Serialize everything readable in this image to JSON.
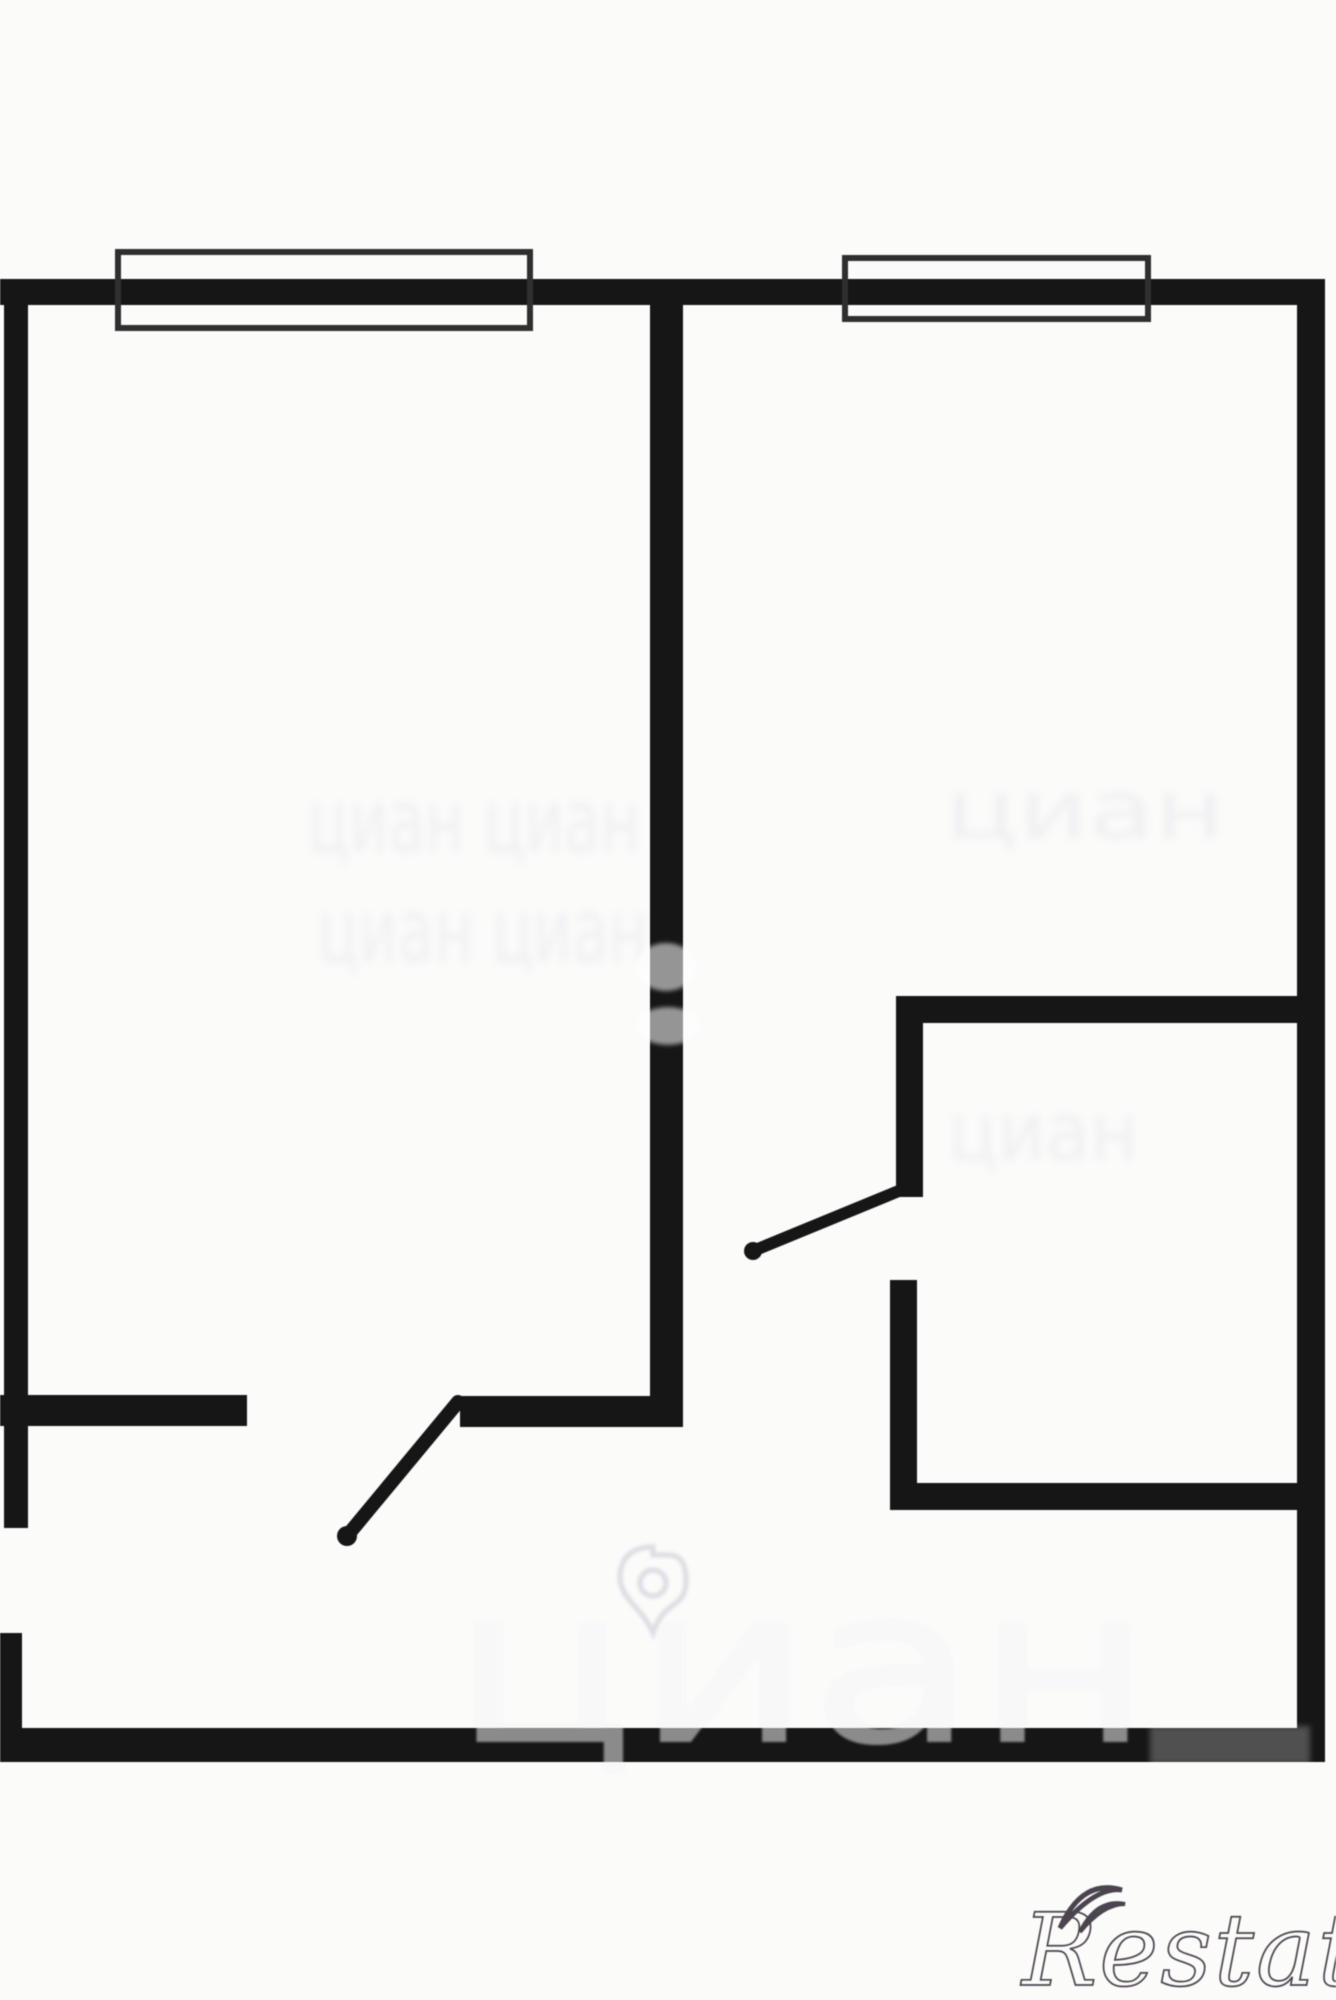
{
  "meta": {
    "width": 1336,
    "height": 2000,
    "background": "#fbfbfa",
    "wall_color": "#161616",
    "window_border_color": "#2f2f2f",
    "watermark_faint_color": "#f0f0f3",
    "watermark_on_wall_color": "rgba(255,255,255,0.5)",
    "logo_color": "#4b444e"
  },
  "floorplan": {
    "walls": [
      {
        "name": "outer-top-wall",
        "x": 0,
        "y": 279,
        "w": 1325,
        "h": 26
      },
      {
        "name": "outer-left-wall-upper",
        "x": 4,
        "y": 279,
        "w": 24,
        "h": 1249
      },
      {
        "name": "outer-left-wall-lower",
        "x": 0,
        "y": 1633,
        "w": 22,
        "h": 100
      },
      {
        "name": "outer-right-wall",
        "x": 1297,
        "y": 279,
        "w": 28,
        "h": 1476
      },
      {
        "name": "outer-bottom-wall",
        "x": 0,
        "y": 1728,
        "w": 1325,
        "h": 34
      },
      {
        "name": "room-divider-wall",
        "x": 650,
        "y": 290,
        "w": 33,
        "h": 1137
      },
      {
        "name": "hall-wall-left-stub",
        "x": 0,
        "y": 1395,
        "w": 247,
        "h": 31
      },
      {
        "name": "hall-wall-right-segment",
        "x": 460,
        "y": 1396,
        "w": 223,
        "h": 31
      },
      {
        "name": "bathroom-top-wall",
        "x": 896,
        "y": 996,
        "w": 401,
        "h": 27
      },
      {
        "name": "bathroom-left-wall-upper",
        "x": 896,
        "y": 996,
        "w": 27,
        "h": 201
      },
      {
        "name": "bathroom-left-wall-lower",
        "x": 890,
        "y": 1280,
        "w": 27,
        "h": 230
      },
      {
        "name": "bathroom-bottom-wall",
        "x": 890,
        "y": 1483,
        "w": 407,
        "h": 27
      }
    ],
    "windows": [
      {
        "name": "window-left-room",
        "x": 118,
        "y": 252,
        "w": 412,
        "h": 76
      },
      {
        "name": "window-right-room",
        "x": 845,
        "y": 258,
        "w": 303,
        "h": 61
      }
    ],
    "doors": [
      {
        "name": "door-living-room-swing",
        "x1": 458,
        "y1": 1402,
        "x2": 347,
        "y2": 1536,
        "stroke": 14,
        "hinge_r": 10
      },
      {
        "name": "door-bathroom-swing",
        "x1": 906,
        "y1": 1188,
        "x2": 753,
        "y2": 1251,
        "stroke": 12,
        "hinge_r": 9
      }
    ]
  },
  "watermarks": {
    "under_texts": [
      {
        "name": "watermark-center-row-1",
        "text": "циан циан",
        "x": 308,
        "y": 852,
        "size": 88,
        "length": 332,
        "blur": 4
      },
      {
        "name": "watermark-center-row-2",
        "text": "циан циан",
        "x": 318,
        "y": 962,
        "size": 88,
        "length": 330,
        "blur": 4
      },
      {
        "name": "watermark-right-room-upper",
        "text": "циан",
        "x": 945,
        "y": 838,
        "size": 80,
        "length": 280,
        "blur": 4
      },
      {
        "name": "watermark-right-room-lower",
        "text": "циан",
        "x": 948,
        "y": 1160,
        "size": 80,
        "length": 190,
        "blur": 4
      },
      {
        "name": "watermark-bottom-big",
        "text": "циан",
        "x": 452,
        "y": 1742,
        "size": 215,
        "length": 700,
        "blur": 2
      }
    ],
    "over_texts": [
      {
        "name": "watermark-bottom-big-overlay",
        "text": "циан",
        "x": 452,
        "y": 1742,
        "size": 215,
        "length": 700,
        "blur": 1
      }
    ],
    "over_blobs": [
      {
        "name": "watermark-fragment-on-divider-1",
        "cx": 666,
        "cy": 967,
        "rx": 30,
        "ry": 24
      },
      {
        "name": "watermark-fragment-on-divider-2",
        "cx": 668,
        "cy": 1026,
        "rx": 32,
        "ry": 19
      }
    ],
    "over_patches": [
      {
        "name": "watermark-patch-bottom-wall",
        "x": 1150,
        "y": 1726,
        "w": 160,
        "h": 38
      }
    ],
    "pin": {
      "name": "cian-pin-watermark",
      "cx": 653,
      "top": 1547,
      "tip": 1633,
      "half_w": 33,
      "circle_r": 13
    }
  },
  "logo": {
    "text": "Restate"
  }
}
